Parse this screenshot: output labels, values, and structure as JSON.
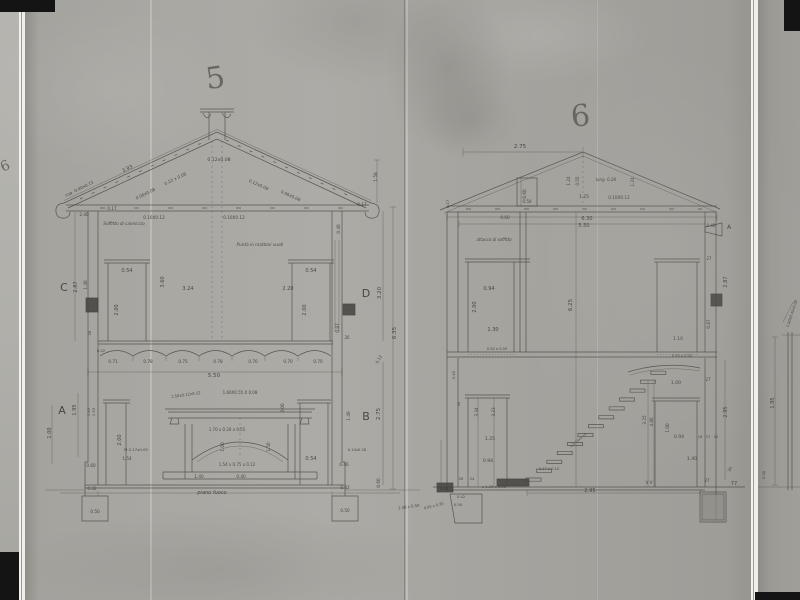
{
  "page": {
    "left_mark": "6"
  },
  "sections": {
    "s5": {
      "number": "5",
      "annotations": [
        {
          "t": "3.93",
          "x": 128,
          "y": 170,
          "r": -26,
          "s": 5
        },
        {
          "t": "cop. 0.40x0.15",
          "x": 80,
          "y": 190,
          "r": -26,
          "s": 4.2
        },
        {
          "t": "0.12x0.08",
          "x": 219,
          "y": 161,
          "s": 4.6
        },
        {
          "t": "0.12 x 0.08",
          "x": 176,
          "y": 180,
          "r": -26,
          "s": 4.2
        },
        {
          "t": "0.06x0.08",
          "x": 146,
          "y": 195,
          "r": -26,
          "s": 4.2
        },
        {
          "t": "0.12x0.08",
          "x": 258,
          "y": 186,
          "r": 24,
          "s": 4.2
        },
        {
          "t": "0.06x0.08",
          "x": 290,
          "y": 197,
          "r": 24,
          "s": 4.2
        },
        {
          "t": "0.17",
          "x": 112,
          "y": 210,
          "s": 4.2
        },
        {
          "t": "0.17",
          "x": 362,
          "y": 206,
          "s": 4.2
        },
        {
          "t": "1.58",
          "x": 377,
          "y": 177,
          "r": -90,
          "s": 4.2
        },
        {
          "t": "2.40",
          "x": 84,
          "y": 216,
          "s": 4.2
        },
        {
          "t": "0.40",
          "x": 340,
          "y": 229,
          "r": -90,
          "s": 4.2
        },
        {
          "t": "Soffitto di canniccio",
          "x": 124,
          "y": 225,
          "s": 4.2,
          "i": 1
        },
        {
          "t": "0.10X0.12",
          "x": 154,
          "y": 219,
          "s": 4.2
        },
        {
          "t": "0.10X0.12",
          "x": 234,
          "y": 219,
          "s": 4.2
        },
        {
          "t": "Punta in mattoni vuoti",
          "x": 260,
          "y": 246,
          "s": 4.2,
          "i": 1
        },
        {
          "t": "C",
          "x": 64,
          "y": 291,
          "s": 11
        },
        {
          "t": "2.87",
          "x": 77,
          "y": 287,
          "r": -90,
          "s": 5
        },
        {
          "t": "1.40",
          "x": 87,
          "y": 285,
          "r": -90,
          "s": 4.2
        },
        {
          "t": "0.54",
          "x": 127,
          "y": 272,
          "s": 5
        },
        {
          "t": "2.00",
          "x": 118,
          "y": 310,
          "r": -90,
          "s": 5
        },
        {
          "t": "3.60",
          "x": 164,
          "y": 282,
          "r": -90,
          "s": 5
        },
        {
          "t": "3.24",
          "x": 188,
          "y": 290,
          "s": 5
        },
        {
          "t": "2.20",
          "x": 288,
          "y": 290,
          "s": 5
        },
        {
          "t": "0.54",
          "x": 311,
          "y": 272,
          "s": 5
        },
        {
          "t": "2.00",
          "x": 306,
          "y": 310,
          "r": -90,
          "s": 5
        },
        {
          "t": "D",
          "x": 366,
          "y": 297,
          "s": 11
        },
        {
          "t": "3.20",
          "x": 381,
          "y": 293,
          "r": -90,
          "s": 5.5
        },
        {
          "t": "0.87",
          "x": 339,
          "y": 328,
          "r": -90,
          "s": 4.2
        },
        {
          "t": "26",
          "x": 347,
          "y": 339,
          "s": 4
        },
        {
          "t": "6.35",
          "x": 396,
          "y": 333,
          "r": -90,
          "s": 5.5
        },
        {
          "t": "0.12",
          "x": 380,
          "y": 360,
          "r": -60,
          "s": 4
        },
        {
          "t": "0.71",
          "x": 113,
          "y": 363,
          "s": 4.2
        },
        {
          "t": "0.78",
          "x": 148,
          "y": 363,
          "s": 4.2
        },
        {
          "t": "0.75",
          "x": 183,
          "y": 363,
          "s": 4.2
        },
        {
          "t": "0.78",
          "x": 218,
          "y": 363,
          "s": 4.2
        },
        {
          "t": "0.70",
          "x": 253,
          "y": 363,
          "s": 4.2
        },
        {
          "t": "0.70",
          "x": 288,
          "y": 363,
          "s": 4.2
        },
        {
          "t": "0.70",
          "x": 318,
          "y": 363,
          "s": 4.2
        },
        {
          "t": "5.50",
          "x": 214,
          "y": 377,
          "s": 5.5
        },
        {
          "t": "A",
          "x": 62,
          "y": 414,
          "s": 11
        },
        {
          "t": "1.95",
          "x": 76,
          "y": 410,
          "r": -90,
          "s": 5
        },
        {
          "t": "1.00",
          "x": 51,
          "y": 433,
          "r": -90,
          "s": 5
        },
        {
          "t": "1.40",
          "x": 90,
          "y": 412,
          "r": -90,
          "s": 3.8
        },
        {
          "t": "1.53",
          "x": 95,
          "y": 412,
          "r": -90,
          "s": 3.8
        },
        {
          "t": "2.00",
          "x": 121,
          "y": 440,
          "r": -90,
          "s": 5
        },
        {
          "t": "M 0.17x0.05",
          "x": 136,
          "y": 451,
          "s": 3.8
        },
        {
          "t": "1.54",
          "x": 127,
          "y": 460,
          "s": 4.2
        },
        {
          "t": "1.50x0.12x0.12",
          "x": 186,
          "y": 396,
          "r": -8,
          "s": 3.8
        },
        {
          "t": "1.60X0.55 X 0.08",
          "x": 240,
          "y": 394,
          "s": 4
        },
        {
          "t": "3.00",
          "x": 284,
          "y": 408,
          "r": -90,
          "s": 4.2
        },
        {
          "t": "1.70 x 0.20 x 0.55",
          "x": 227,
          "y": 431,
          "s": 4
        },
        {
          "t": "1.00",
          "x": 224,
          "y": 447,
          "r": -90,
          "s": 4.2
        },
        {
          "t": "1.50",
          "x": 270,
          "y": 447,
          "r": -90,
          "s": 4.2
        },
        {
          "t": "1.54 x 0.75 x 0.12",
          "x": 237,
          "y": 466,
          "s": 4
        },
        {
          "t": "1.40",
          "x": 199,
          "y": 478,
          "s": 4.2
        },
        {
          "t": "0.40",
          "x": 241,
          "y": 478,
          "s": 4.2
        },
        {
          "t": "piano fuoco",
          "x": 212,
          "y": 494,
          "s": 5,
          "i": 1
        },
        {
          "t": "B",
          "x": 366,
          "y": 420,
          "s": 11
        },
        {
          "t": "2.75",
          "x": 380,
          "y": 414,
          "r": -90,
          "s": 5.5
        },
        {
          "t": "1.49",
          "x": 350,
          "y": 416,
          "r": -90,
          "s": 4.2
        },
        {
          "t": "0.54",
          "x": 311,
          "y": 460,
          "s": 5
        },
        {
          "t": "0.10x0.28",
          "x": 357,
          "y": 451,
          "s": 3.6
        },
        {
          "t": "0.46",
          "x": 344,
          "y": 466,
          "s": 4.2
        },
        {
          "t": "0.42",
          "x": 345,
          "y": 489,
          "s": 4.2
        },
        {
          "t": "0.50",
          "x": 345,
          "y": 512,
          "s": 4.2
        },
        {
          "t": "0.60",
          "x": 380,
          "y": 483,
          "r": -90,
          "s": 4.2
        },
        {
          "t": "1.48 x 0.50",
          "x": 409,
          "y": 508,
          "r": -8,
          "s": 3.8
        },
        {
          "t": "0.60",
          "x": 91,
          "y": 467,
          "s": 4.2
        },
        {
          "t": "0.42",
          "x": 92,
          "y": 490,
          "s": 4.2
        },
        {
          "t": "0.50",
          "x": 95,
          "y": 513,
          "s": 4.2
        },
        {
          "t": "0.42",
          "x": 101,
          "y": 352,
          "s": 3.8
        },
        {
          "t": "26",
          "x": 91,
          "y": 333,
          "r": -90,
          "s": 3.8
        }
      ]
    },
    "s6": {
      "number": "6",
      "annotations": [
        {
          "t": "2.75",
          "x": 520,
          "y": 148,
          "s": 5.5
        },
        {
          "t": "0.60",
          "x": 526,
          "y": 194,
          "r": -90,
          "s": 4.2
        },
        {
          "t": "0.50",
          "x": 527,
          "y": 203,
          "s": 4
        },
        {
          "t": "1.24",
          "x": 570,
          "y": 181,
          "r": -90,
          "s": 4.2
        },
        {
          "t": "0.55",
          "x": 579,
          "y": 181,
          "r": -90,
          "s": 4
        },
        {
          "t": "lung. 0.28",
          "x": 606,
          "y": 181,
          "s": 4,
          "i": 1
        },
        {
          "t": "1.24",
          "x": 634,
          "y": 182,
          "r": -90,
          "s": 4.2
        },
        {
          "t": "1.25",
          "x": 584,
          "y": 198,
          "s": 4.6
        },
        {
          "t": "0.10X0.12",
          "x": 619,
          "y": 199,
          "s": 4.2
        },
        {
          "t": "0.17",
          "x": 449,
          "y": 204,
          "r": -90,
          "s": 3.8
        },
        {
          "t": "6.30",
          "x": 587,
          "y": 220,
          "s": 5
        },
        {
          "t": "5.50",
          "x": 584,
          "y": 227,
          "s": 5
        },
        {
          "t": "0.60",
          "x": 505,
          "y": 219,
          "s": 4.2
        },
        {
          "t": "0.40",
          "x": 711,
          "y": 227,
          "s": 4
        },
        {
          "t": "A",
          "x": 729,
          "y": 229,
          "s": 6
        },
        {
          "t": "attacco di soffitto",
          "x": 494,
          "y": 241,
          "s": 4,
          "i": 1
        },
        {
          "t": "0.94",
          "x": 489,
          "y": 290,
          "s": 5
        },
        {
          "t": "2.00",
          "x": 476,
          "y": 307,
          "r": -90,
          "s": 5
        },
        {
          "t": "1.30",
          "x": 493,
          "y": 331,
          "s": 5
        },
        {
          "t": "6.25",
          "x": 572,
          "y": 305,
          "r": -90,
          "s": 5.5
        },
        {
          "t": "0.50 x 0.05",
          "x": 497,
          "y": 350,
          "s": 3.6
        },
        {
          "t": "27",
          "x": 709,
          "y": 260,
          "s": 4
        },
        {
          "t": "0.87",
          "x": 710,
          "y": 324,
          "r": -90,
          "s": 4.2
        },
        {
          "t": "2.87",
          "x": 727,
          "y": 282,
          "r": -90,
          "s": 5
        },
        {
          "t": "1.10",
          "x": 678,
          "y": 340,
          "s": 4.6
        },
        {
          "t": "0.50 x 0.05",
          "x": 682,
          "y": 357,
          "s": 3.6
        },
        {
          "t": "1.00",
          "x": 676,
          "y": 384,
          "s": 4.6
        },
        {
          "t": "27",
          "x": 708,
          "y": 381,
          "s": 4
        },
        {
          "t": "3.34",
          "x": 478,
          "y": 412,
          "r": -90,
          "s": 4.2
        },
        {
          "t": "3.23",
          "x": 495,
          "y": 412,
          "r": -90,
          "s": 4.2
        },
        {
          "t": "1.25",
          "x": 490,
          "y": 440,
          "s": 4.6
        },
        {
          "t": "0.94",
          "x": 488,
          "y": 462,
          "s": 4.6
        },
        {
          "t": "26",
          "x": 460,
          "y": 404,
          "r": -90,
          "s": 3.8
        },
        {
          "t": "0.40",
          "x": 455,
          "y": 375,
          "r": -90,
          "s": 3.8
        },
        {
          "t": "0.17 x 0.10",
          "x": 549,
          "y": 470,
          "s": 3.6
        },
        {
          "t": "x 0.15x0.10",
          "x": 579,
          "y": 441,
          "r": -40,
          "s": 3.4
        },
        {
          "t": "3.25",
          "x": 646,
          "y": 420,
          "r": -90,
          "s": 4.2
        },
        {
          "t": "4.80",
          "x": 653,
          "y": 422,
          "r": -90,
          "s": 4.2
        },
        {
          "t": "1.00",
          "x": 669,
          "y": 428,
          "r": -90,
          "s": 4.2
        },
        {
          "t": "0.94",
          "x": 679,
          "y": 438,
          "s": 4.6
        },
        {
          "t": "1.40",
          "x": 692,
          "y": 460,
          "s": 4.6
        },
        {
          "t": "16",
          "x": 700,
          "y": 438,
          "s": 3.6
        },
        {
          "t": "27",
          "x": 708,
          "y": 438,
          "s": 3.6
        },
        {
          "t": "10",
          "x": 716,
          "y": 438,
          "s": 3.6
        },
        {
          "t": "27",
          "x": 707,
          "y": 482,
          "s": 4
        },
        {
          "t": "2.95",
          "x": 727,
          "y": 412,
          "r": -90,
          "s": 5
        },
        {
          "t": "30",
          "x": 731,
          "y": 470,
          "r": -60,
          "s": 3.8
        },
        {
          "t": "2.95",
          "x": 590,
          "y": 492,
          "s": 5
        },
        {
          "t": "26",
          "x": 461,
          "y": 480,
          "s": 3.6
        },
        {
          "t": "24",
          "x": 472,
          "y": 480,
          "s": 3.6
        },
        {
          "t": "0.65",
          "x": 444,
          "y": 490,
          "s": 3.8
        },
        {
          "t": "x 1.25 x 0.06",
          "x": 494,
          "y": 488,
          "s": 3.6
        },
        {
          "t": "0.42",
          "x": 461,
          "y": 498,
          "s": 3.8
        },
        {
          "t": "0.50",
          "x": 458,
          "y": 506,
          "s": 3.8
        },
        {
          "t": "0.65 x 0.20",
          "x": 434,
          "y": 507,
          "r": -14,
          "s": 3.6
        },
        {
          "t": "V V",
          "x": 649,
          "y": 484,
          "s": 4.2
        },
        {
          "t": "77",
          "x": 734,
          "y": 485,
          "s": 5
        }
      ]
    }
  },
  "fragment": {
    "annotations": [
      {
        "t": "1.95",
        "x": 774,
        "y": 403,
        "r": -90,
        "s": 5
      },
      {
        "t": "0.30",
        "x": 765,
        "y": 475,
        "r": -90,
        "s": 3.8
      },
      {
        "t": "1.00x0.42x0.08",
        "x": 793,
        "y": 314,
        "r": -72,
        "s": 3.6
      }
    ]
  }
}
